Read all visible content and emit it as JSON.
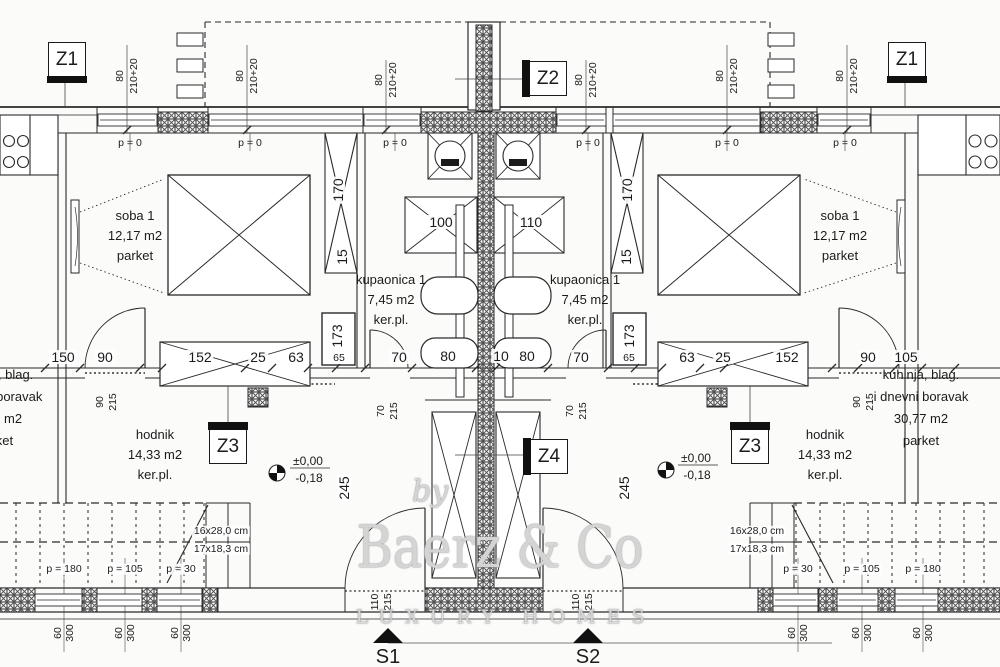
{
  "colors": {
    "ink": "#2a2a2a",
    "paper": "#fbfbfa",
    "hatch": "#555555",
    "marker_fill": "#111111"
  },
  "plan": {
    "marks": {
      "z1": "Z1",
      "z2": "Z2",
      "z3": "Z3",
      "z4": "Z4",
      "s1": "S1",
      "s2": "S2"
    },
    "rooms": {
      "soba": {
        "name": "soba 1",
        "area": "12,17 m2",
        "floor": "parket"
      },
      "kupaonica": {
        "name": "kupaonica 1",
        "area": "7,45 m2",
        "floor": "ker.pl."
      },
      "hodnik": {
        "name": "hodnik",
        "area": "14,33 m2",
        "floor": "ker.pl."
      },
      "kuhinja": {
        "name_line1": "kuhinja, blag.",
        "name_line2": "i dnevni boravak",
        "area": "30,77 m2",
        "floor": "parket"
      }
    },
    "elevation": {
      "above": "±0,00",
      "below": "-0,18"
    },
    "stairs": {
      "flight1": "16x28,0 cm",
      "flight2": "17x18,3 cm",
      "p180": "p = 180",
      "p105": "p = 105",
      "p30": "p = 30"
    },
    "dims": {
      "w80": "80",
      "h210": "210+20",
      "p0": "p = 0",
      "d150": "150",
      "d90": "90",
      "d152": "152",
      "d25": "25",
      "d63": "63",
      "d105": "105",
      "d100": "100",
      "d110": "110",
      "d70": "70",
      "d10": "10",
      "d15": "15",
      "d170": "170",
      "d173": "173",
      "d65": "65",
      "d245": "245",
      "d215": "215",
      "d60": "60",
      "d300": "300"
    },
    "watermark": {
      "by": "by",
      "name": "Baerz & Co",
      "tagline": "LUXURY HOMES"
    }
  }
}
